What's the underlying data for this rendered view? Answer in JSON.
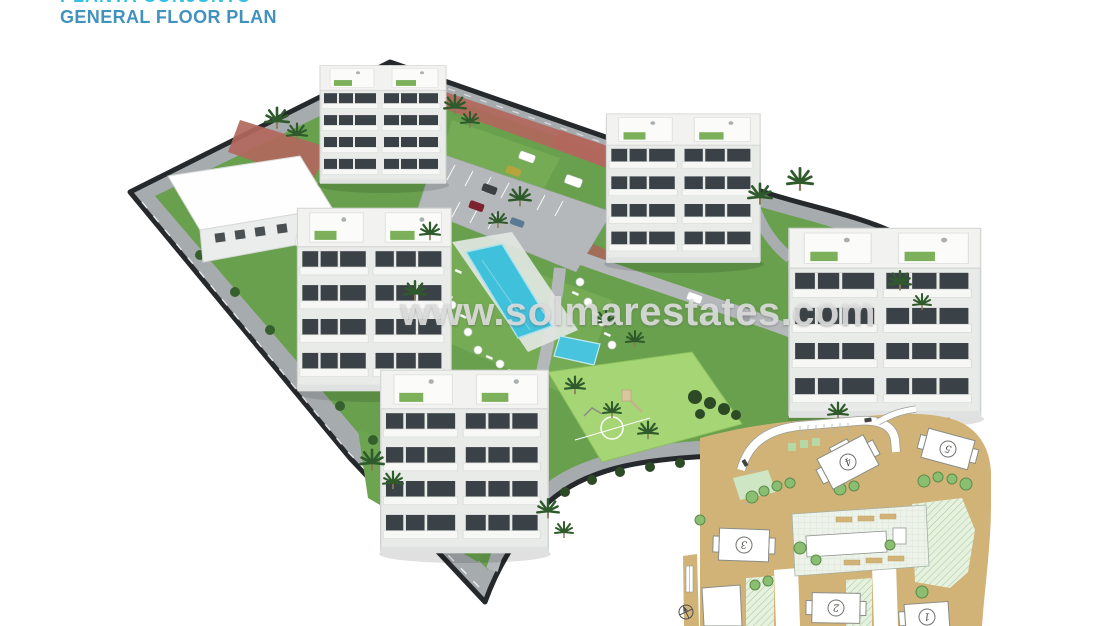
{
  "header": {
    "title_line1": "PLANTA CONJUNTO",
    "title_line2": "GENERAL FLOOR PLAN"
  },
  "watermark": {
    "text": "www.solmarestates.com"
  },
  "render_3d": {
    "description": "aerial 3D render of a white apartment complex with pool, playground, parking and perimeter roads"
  },
  "site_plan": {
    "buildings": [
      {
        "number": "1"
      },
      {
        "number": "2"
      },
      {
        "number": "3"
      },
      {
        "number": "4"
      },
      {
        "number": "5"
      }
    ]
  },
  "colors": {
    "title_primary": "#32c0e4",
    "title_secondary": "#4292be",
    "watermark": "#e0e0e0",
    "lawn": "#68a04e",
    "pool": "#3fc0db",
    "road": "#b4b8ba",
    "boundary": "#26292b",
    "plan_sand": "#d2b377",
    "plan_green": "#cfe6c4",
    "brick_path": "#b2675c"
  }
}
